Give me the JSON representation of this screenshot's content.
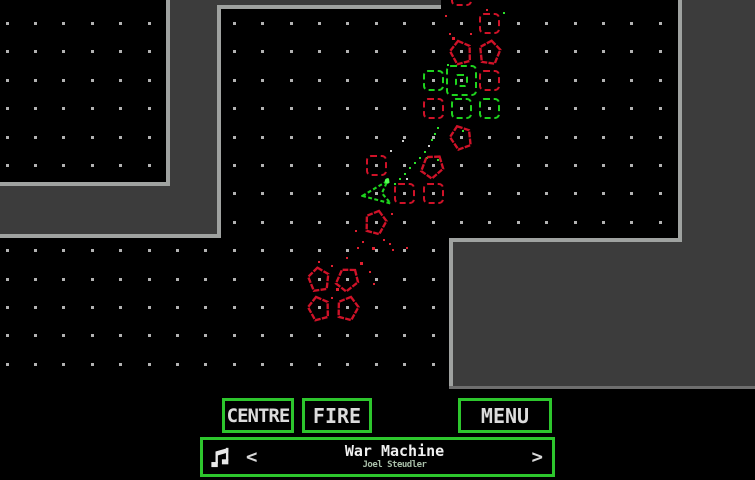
{
  "colors": {
    "bg": "#000000",
    "ui_green": "#2dc62d",
    "btn_text": "#dcdcdc",
    "red": "#d01228",
    "green": "#1ed41e",
    "player_dot": "#53ff53",
    "dot": "#b2b2b2",
    "wall": "#3c3c3c",
    "wall_edge": "#9fa2a0",
    "wall_edge_dim": "#6e6e6e"
  },
  "grid": {
    "ox": 7,
    "oy": 23.5,
    "step": 28.4,
    "dot_size": 3,
    "rows": [
      {
        "j_from": 0,
        "j_to": 5,
        "i_ranges": [
          [
            0,
            5
          ],
          [
            8,
            23
          ]
        ]
      },
      {
        "j_from": 6,
        "j_to": 7,
        "i_ranges": [
          [
            8,
            23
          ]
        ]
      },
      {
        "j_from": 8,
        "j_to": 12,
        "i_ranges": [
          [
            0,
            15
          ]
        ]
      }
    ]
  },
  "walls": {
    "fills": [
      {
        "x": 170,
        "y": 0,
        "w": 47,
        "h": 234
      },
      {
        "x": 0,
        "y": 186,
        "w": 217,
        "h": 48
      },
      {
        "x": 217,
        "y": 0,
        "w": 224,
        "h": 5
      },
      {
        "x": 682,
        "y": 0,
        "w": 73,
        "h": 243
      },
      {
        "x": 453,
        "y": 242,
        "w": 302,
        "h": 146
      }
    ],
    "edges": [
      {
        "x": 166,
        "y": 0,
        "w": 4,
        "h": 186
      },
      {
        "x": 0,
        "y": 182,
        "w": 166,
        "h": 4
      },
      {
        "x": 217,
        "y": 5,
        "w": 4,
        "h": 229
      },
      {
        "x": 0,
        "y": 234,
        "w": 221,
        "h": 4
      },
      {
        "x": 221,
        "y": 5,
        "w": 220,
        "h": 4
      },
      {
        "x": 678,
        "y": 0,
        "w": 4,
        "h": 240
      },
      {
        "x": 453,
        "y": 238,
        "w": 229,
        "h": 4
      },
      {
        "x": 449,
        "y": 238,
        "w": 4,
        "h": 150
      },
      {
        "x": 449,
        "y": 386,
        "w": 306,
        "h": 3,
        "dim": true
      }
    ]
  },
  "units": [
    {
      "kind": "box",
      "color": "red",
      "i": 16,
      "j": -1,
      "rot": 0
    },
    {
      "kind": "box",
      "color": "red",
      "i": 17,
      "j": 0,
      "rot": 0
    },
    {
      "kind": "pentagon",
      "color": "red",
      "i": 16,
      "j": 1,
      "rot": -15
    },
    {
      "kind": "pentagon",
      "color": "red",
      "i": 17,
      "j": 1,
      "rot": 8
    },
    {
      "kind": "box",
      "color": "green",
      "i": 15,
      "j": 2,
      "rot": 0
    },
    {
      "kind": "box_big",
      "color": "green",
      "i": 16,
      "j": 2,
      "rot": 0
    },
    {
      "kind": "box",
      "color": "red",
      "i": 17,
      "j": 2,
      "rot": 0
    },
    {
      "kind": "box",
      "color": "red",
      "i": 15,
      "j": 3,
      "rot": 0
    },
    {
      "kind": "box",
      "color": "green",
      "i": 16,
      "j": 3,
      "rot": 0
    },
    {
      "kind": "box",
      "color": "green",
      "i": 17,
      "j": 3,
      "rot": 0
    },
    {
      "kind": "pentagon",
      "color": "red",
      "i": 16,
      "j": 4,
      "rot": -20
    },
    {
      "kind": "box",
      "color": "red",
      "i": 13,
      "j": 5,
      "rot": 0
    },
    {
      "kind": "pentagon",
      "color": "red",
      "i": 15,
      "j": 5,
      "rot": 35
    },
    {
      "kind": "player",
      "color": "green",
      "i": 13,
      "j": 6,
      "rot": -8
    },
    {
      "kind": "box",
      "color": "red",
      "i": 14,
      "j": 6,
      "rot": 0
    },
    {
      "kind": "box",
      "color": "red",
      "i": 15,
      "j": 6,
      "rot": 0
    },
    {
      "kind": "pentagon",
      "color": "red",
      "i": 13,
      "j": 7,
      "rot": 15
    },
    {
      "kind": "pentagon",
      "color": "red",
      "i": 11,
      "j": 9,
      "rot": -8
    },
    {
      "kind": "pentagon",
      "color": "red",
      "i": 12,
      "j": 9,
      "rot": 38
    },
    {
      "kind": "pentagon",
      "color": "red",
      "i": 11,
      "j": 10,
      "rot": -15
    },
    {
      "kind": "pentagon",
      "color": "red",
      "i": 12,
      "j": 10,
      "rot": 15
    }
  ],
  "particles": [
    {
      "x": 394,
      "y": 183,
      "c": "green",
      "s": 2
    },
    {
      "x": 399,
      "y": 178,
      "c": "green",
      "s": 2
    },
    {
      "x": 404,
      "y": 173,
      "c": "green",
      "s": 2
    },
    {
      "x": 409,
      "y": 167,
      "c": "green",
      "s": 2
    },
    {
      "x": 414,
      "y": 162,
      "c": "green",
      "s": 2
    },
    {
      "x": 419,
      "y": 157,
      "c": "green",
      "s": 2
    },
    {
      "x": 424,
      "y": 151,
      "c": "green",
      "s": 2
    },
    {
      "x": 428,
      "y": 145,
      "c": "white",
      "s": 2
    },
    {
      "x": 431,
      "y": 139,
      "c": "green",
      "s": 2
    },
    {
      "x": 434,
      "y": 133,
      "c": "green",
      "s": 2
    },
    {
      "x": 437,
      "y": 127,
      "c": "green",
      "s": 2
    },
    {
      "x": 447,
      "y": 64,
      "c": "green",
      "s": 2
    },
    {
      "x": 462,
      "y": 130,
      "c": "green",
      "s": 2
    },
    {
      "x": 426,
      "y": 157,
      "c": "green",
      "s": 2
    },
    {
      "x": 437,
      "y": 159,
      "c": "green",
      "s": 2
    },
    {
      "x": 503,
      "y": 12,
      "c": "green",
      "s": 2
    },
    {
      "x": 390,
      "y": 150,
      "c": "white",
      "s": 2
    },
    {
      "x": 406,
      "y": 178,
      "c": "white",
      "s": 2
    },
    {
      "x": 402,
      "y": 140,
      "c": "white",
      "s": 2
    },
    {
      "x": 445,
      "y": 15,
      "c": "red",
      "s": 2
    },
    {
      "x": 449,
      "y": 33,
      "c": "red",
      "s": 2
    },
    {
      "x": 452,
      "y": 37,
      "c": "red",
      "s": 3
    },
    {
      "x": 470,
      "y": 33,
      "c": "red",
      "s": 2
    },
    {
      "x": 486,
      "y": 9,
      "c": "red",
      "s": 2
    },
    {
      "x": 355,
      "y": 230,
      "c": "red",
      "s": 2
    },
    {
      "x": 362,
      "y": 241,
      "c": "red",
      "s": 2
    },
    {
      "x": 372,
      "y": 247,
      "c": "red",
      "s": 3
    },
    {
      "x": 383,
      "y": 239,
      "c": "red",
      "s": 2
    },
    {
      "x": 392,
      "y": 249,
      "c": "red",
      "s": 2
    },
    {
      "x": 391,
      "y": 213,
      "c": "red",
      "s": 2
    },
    {
      "x": 318,
      "y": 261,
      "c": "red",
      "s": 2
    },
    {
      "x": 331,
      "y": 265,
      "c": "red",
      "s": 2
    },
    {
      "x": 346,
      "y": 257,
      "c": "red",
      "s": 2
    },
    {
      "x": 360,
      "y": 262,
      "c": "red",
      "s": 3
    },
    {
      "x": 369,
      "y": 271,
      "c": "red",
      "s": 2
    },
    {
      "x": 373,
      "y": 283,
      "c": "red",
      "s": 2
    },
    {
      "x": 336,
      "y": 288,
      "c": "red",
      "s": 3
    },
    {
      "x": 331,
      "y": 297,
      "c": "red",
      "s": 2
    },
    {
      "x": 357,
      "y": 247,
      "c": "red",
      "s": 2
    },
    {
      "x": 389,
      "y": 243,
      "c": "red",
      "s": 2
    },
    {
      "x": 406,
      "y": 247,
      "c": "red",
      "s": 2
    }
  ],
  "hud": {
    "buttons": [
      {
        "id": "centre",
        "label": "CENTRE"
      },
      {
        "id": "fire",
        "label": "FIRE"
      },
      {
        "id": "menu",
        "label": "MENU"
      }
    ],
    "music": {
      "title": "War Machine",
      "artist": "Joel Steudler",
      "prev": "<",
      "next": ">",
      "icon": "beamed-music-note"
    }
  }
}
